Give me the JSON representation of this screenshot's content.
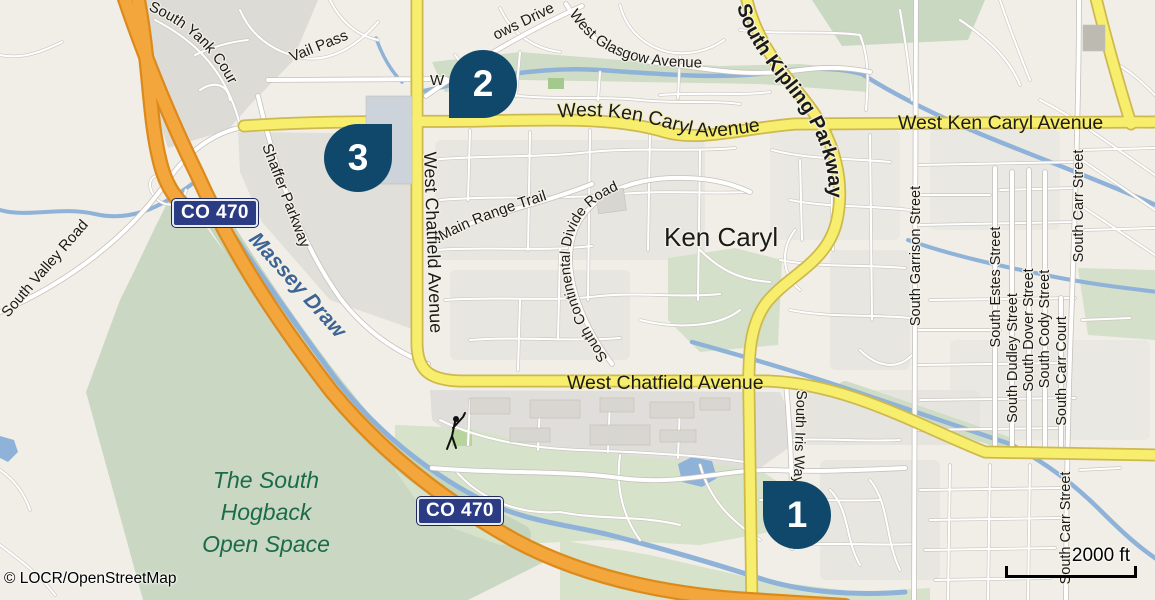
{
  "map": {
    "attribution": "© LOCR/OpenStreetMap",
    "scale_bar_label": "2000 ft",
    "markers": [
      {
        "number": "1"
      },
      {
        "number": "2"
      },
      {
        "number": "3"
      }
    ],
    "route_shields": [
      {
        "label": "CO 470"
      },
      {
        "label": "CO 470"
      }
    ],
    "place_labels": {
      "neighborhood": "Ken Caryl",
      "open_space": [
        "The South",
        "Hogback",
        "Open Space"
      ],
      "waterway": "Massey Draw"
    },
    "road_labels": {
      "ken_caryl_ave_west": "West Ken Caryl Avenue",
      "ken_caryl_ave_east": "West Ken Caryl Avenue",
      "chatfield_ave_vertical": "West Chatfield Avenue",
      "chatfield_ave_horizontal": "West Chatfield Avenue",
      "kipling_parkway": "South Kipling Parkway",
      "valley_road": "South Valley Road",
      "yank_court": "South Yank Court",
      "vail_pass": "Vail Pass",
      "ows_drive_partial": "ows Drive",
      "glasgow_ave": "West Glasgow Avenue",
      "shaffer_parkway": "Shaffer Parkway",
      "main_range_trail": "Main Range Trail",
      "continental_divide_road": "South Continental Divide Road",
      "garrison_street": "South Garrison Street",
      "estes_street": "South Estes Street",
      "dudley_street": "South Dudley Street",
      "dover_street": "South Dover Street",
      "cody_street": "South Cody Street",
      "carr_court": "South Carr Court",
      "carr_street_north": "South Carr Street",
      "carr_street_south": "South Carr Street",
      "iris_way": "South Iris Way",
      "hidden_west_label": "W"
    },
    "colors": {
      "marker": "#10486B",
      "shield_background": "#2B3C84",
      "motorway_orange": "#F3A63C",
      "primary_road_yellow": "#F7EE6E",
      "water_blue": "#8FB2D9",
      "open_space_green": "#CAD8C3",
      "open_space_text_green": "#1B6B4B",
      "waterway_text_blue": "#3D6494"
    }
  }
}
